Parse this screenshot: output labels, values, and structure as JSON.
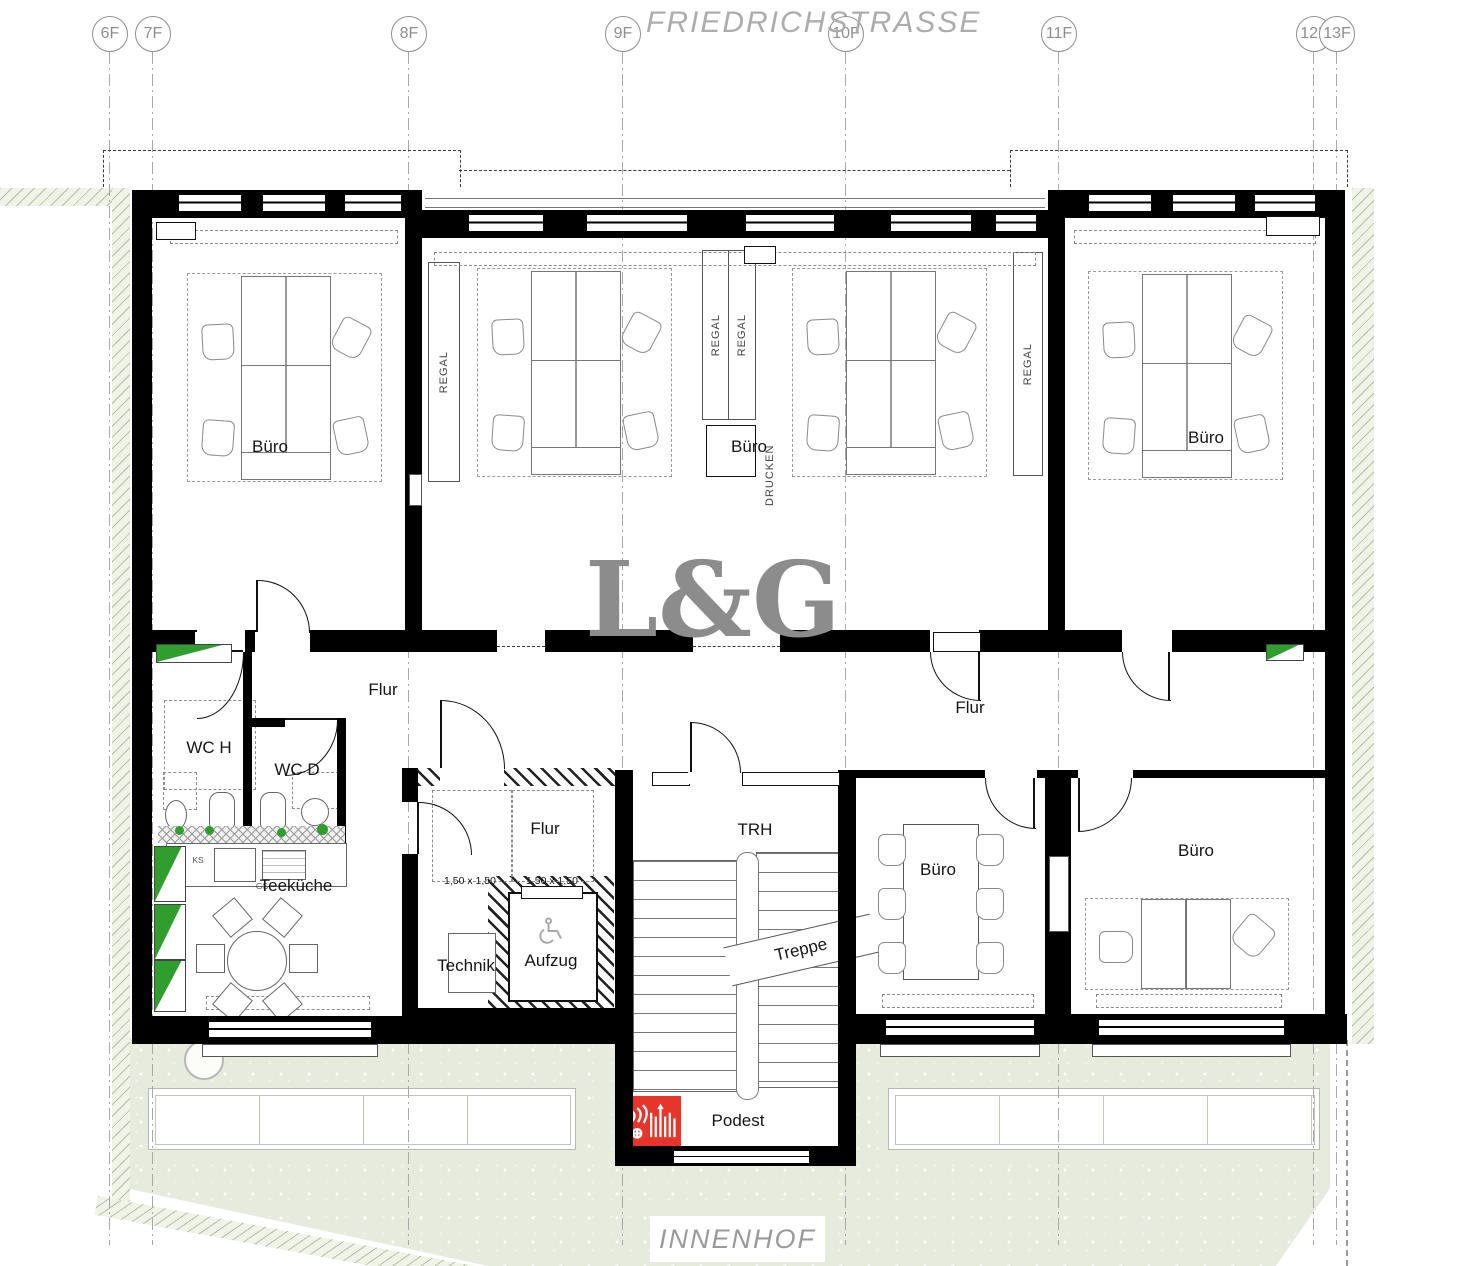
{
  "street_label": "FRIEDRICHSTRASSE",
  "courtyard_label": "INNENHOF",
  "watermark": "L&G",
  "axes": [
    {
      "label": "6F"
    },
    {
      "label": "7F"
    },
    {
      "label": "8F"
    },
    {
      "label": "9F"
    },
    {
      "label": "10F"
    },
    {
      "label": "11F"
    },
    {
      "label": "12F"
    },
    {
      "label": "13F"
    }
  ],
  "rooms": {
    "buero": "Büro",
    "flur": "Flur",
    "wc_h": "WC H",
    "wc_d": "WC D",
    "teekueche": "Teeküche",
    "technik": "Technik",
    "aufzug": "Aufzug",
    "trh": "TRH",
    "treppe": "Treppe",
    "podest": "Podest"
  },
  "annotations": {
    "regal": "REGAL",
    "drucken": "DRUCKEN",
    "ks": "KS",
    "gs": "GS",
    "elevator_clearance": "1,50 x 1,50"
  },
  "colors": {
    "wall": "#000000",
    "accent_green": "#2f9e2f",
    "fire_red": "#e8352b",
    "courtyard_green": "#e7ebdd",
    "text_gray": "#9a9a9a"
  }
}
